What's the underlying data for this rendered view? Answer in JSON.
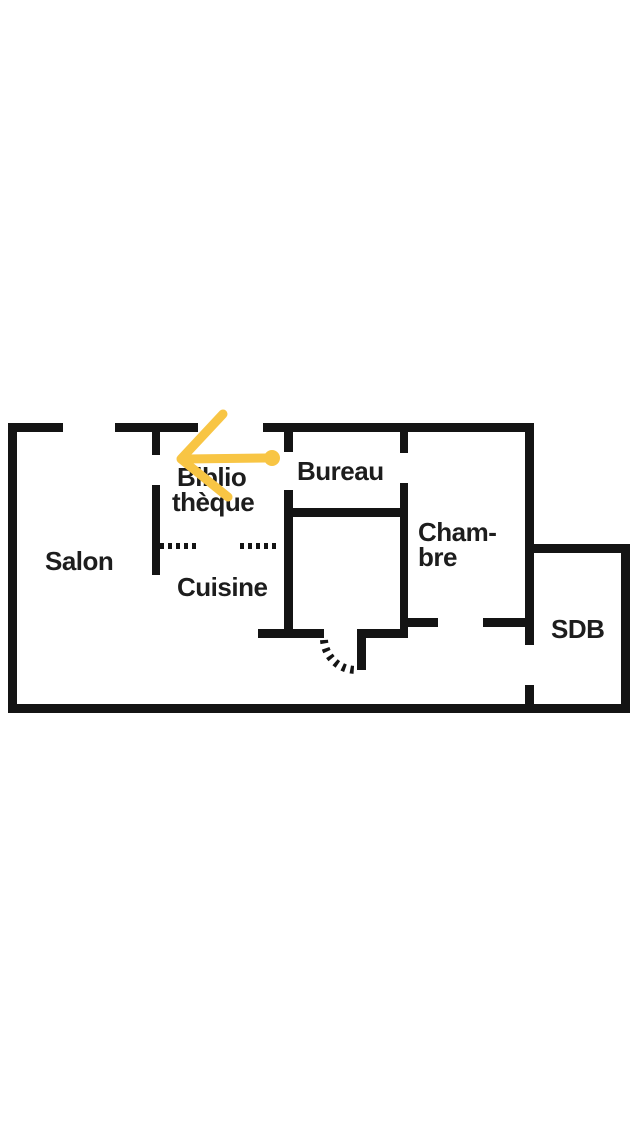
{
  "canvas": {
    "width": 640,
    "height": 1136,
    "background_color": "#ffffff"
  },
  "floor_plan": {
    "wall_color": "#141414",
    "label_color": "#1d1d1d",
    "rooms": [
      {
        "id": "salon",
        "name": "Salon",
        "lines": [
          {
            "text": "Salon",
            "x": 45,
            "y": 570
          }
        ]
      },
      {
        "id": "bibliotheque",
        "name": "Bibliothèque",
        "lines": [
          {
            "text": "Biblio",
            "x": 177,
            "y": 486
          },
          {
            "text": "thèque",
            "x": 172,
            "y": 511
          }
        ]
      },
      {
        "id": "bureau",
        "name": "Bureau",
        "lines": [
          {
            "text": "Bureau",
            "x": 297,
            "y": 480
          }
        ]
      },
      {
        "id": "cuisine",
        "name": "Cuisine",
        "lines": [
          {
            "text": "Cuisine",
            "x": 177,
            "y": 596
          }
        ]
      },
      {
        "id": "chambre",
        "name": "Chambre",
        "lines": [
          {
            "text": "Cham-",
            "x": 418,
            "y": 541
          },
          {
            "text": "bre",
            "x": 418,
            "y": 566
          }
        ]
      },
      {
        "id": "sdb",
        "name": "SDB",
        "lines": [
          {
            "text": "SDB",
            "x": 551,
            "y": 638
          }
        ]
      }
    ],
    "walls": [
      {
        "name": "top-wall-left",
        "x": 8,
        "y": 423,
        "w": 55,
        "h": 9
      },
      {
        "name": "top-wall-mid",
        "x": 115,
        "y": 423,
        "w": 83,
        "h": 9
      },
      {
        "name": "top-wall-right",
        "x": 263,
        "y": 423,
        "w": 271,
        "h": 9
      },
      {
        "name": "left-wall",
        "x": 8,
        "y": 423,
        "w": 9,
        "h": 290
      },
      {
        "name": "bottom-wall",
        "x": 8,
        "y": 704,
        "w": 622,
        "h": 9
      },
      {
        "name": "right-wall-upper",
        "x": 525,
        "y": 423,
        "w": 9,
        "h": 222
      },
      {
        "name": "right-wall-lower",
        "x": 525,
        "y": 685,
        "w": 9,
        "h": 28
      },
      {
        "name": "sdb-top-wall",
        "x": 534,
        "y": 544,
        "w": 96,
        "h": 9
      },
      {
        "name": "sdb-right-wall",
        "x": 621,
        "y": 544,
        "w": 9,
        "h": 169
      },
      {
        "name": "salon-biblio-wall-upper",
        "x": 152,
        "y": 432,
        "w": 8,
        "h": 23
      },
      {
        "name": "salon-biblio-wall-lower",
        "x": 152,
        "y": 485,
        "w": 8,
        "h": 90
      },
      {
        "name": "biblio-bureau-wall",
        "x": 284,
        "y": 432,
        "w": 9,
        "h": 20
      },
      {
        "name": "cuisine-storage-wall",
        "x": 284,
        "y": 490,
        "w": 9,
        "h": 148
      },
      {
        "name": "bureau-chambre-wall-upper",
        "x": 400,
        "y": 423,
        "w": 8,
        "h": 30
      },
      {
        "name": "bureau-chambre-wall-lower",
        "x": 400,
        "y": 483,
        "w": 8,
        "h": 155
      },
      {
        "name": "storage-top-wall",
        "x": 293,
        "y": 508,
        "w": 107,
        "h": 9
      },
      {
        "name": "storage-bottom-wall-left",
        "x": 258,
        "y": 629,
        "w": 66,
        "h": 9
      },
      {
        "name": "storage-bottom-wall-right",
        "x": 357,
        "y": 629,
        "w": 51,
        "h": 9
      },
      {
        "name": "storage-door-jamb",
        "x": 357,
        "y": 629,
        "w": 9,
        "h": 41
      },
      {
        "name": "chambre-bottom-wall-left",
        "x": 408,
        "y": 618,
        "w": 30,
        "h": 9
      },
      {
        "name": "chambre-bottom-wall-right",
        "x": 483,
        "y": 618,
        "w": 42,
        "h": 9
      }
    ],
    "dotted_partitions": [
      {
        "name": "cuisine-dotted-partition-left",
        "x1": 160,
        "y1": 546,
        "x2": 197,
        "y2": 546,
        "width": 6,
        "dash": "4 4"
      },
      {
        "name": "cuisine-dotted-partition-right",
        "x1": 240,
        "y1": 546,
        "x2": 277,
        "y2": 546,
        "width": 6,
        "dash": "4 4"
      }
    ],
    "door_arc": {
      "name": "storage-door-swing-arc",
      "d": "M 324 640 A 32 32 0 0 0 356 670",
      "width": 8,
      "dash": "3.5 5"
    },
    "annotation_arrow": {
      "color": "#F8C544",
      "width": 9,
      "head_points": [
        [
          223,
          414
        ],
        [
          181,
          459
        ],
        [
          228,
          497
        ]
      ],
      "shaft": {
        "x1": 186,
        "y1": 459,
        "x2": 266,
        "y2": 458
      },
      "dot": {
        "cx": 272,
        "cy": 458,
        "r": 8
      }
    }
  }
}
